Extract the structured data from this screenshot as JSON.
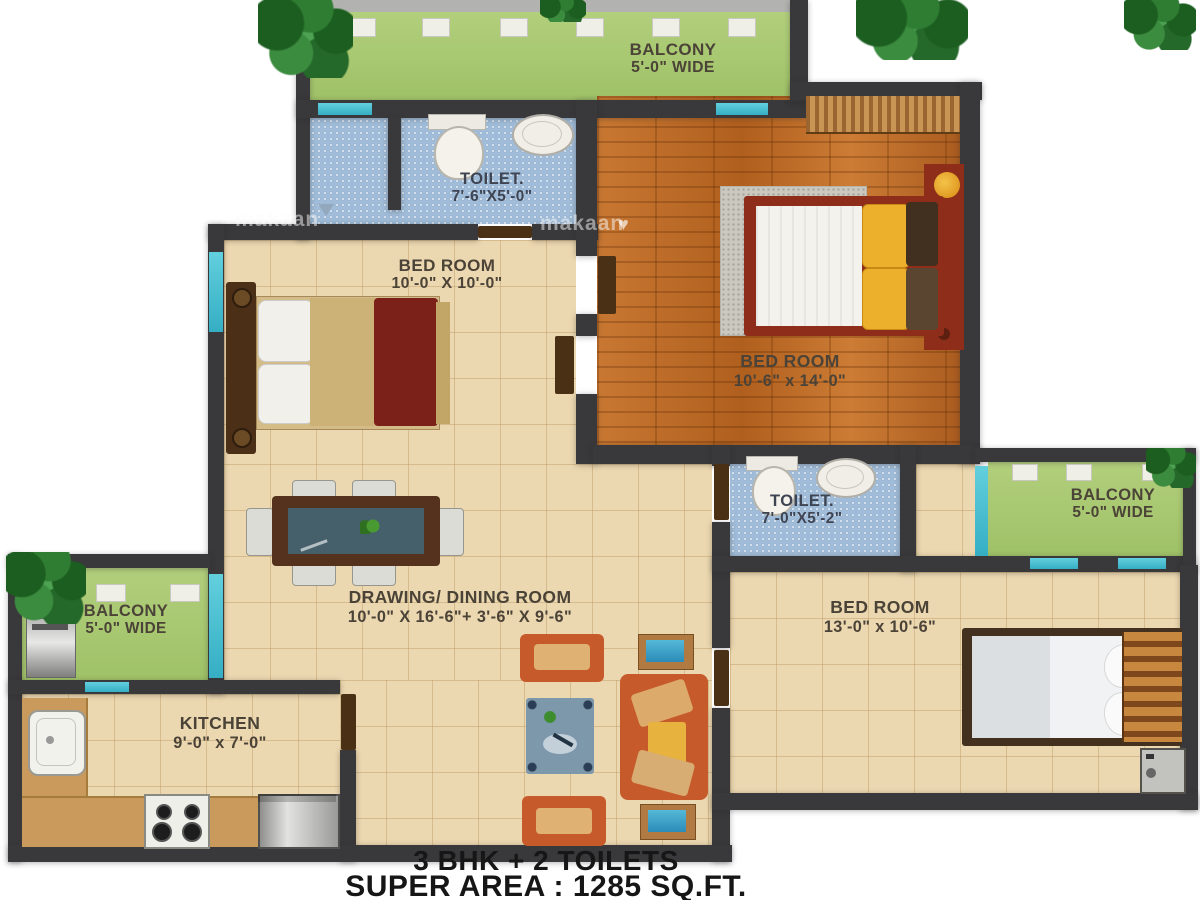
{
  "rooms": {
    "balcony_top": {
      "label": "BALCONY",
      "dims": "5'-0\" WIDE"
    },
    "toilet_top": {
      "label": "TOILET.",
      "dims": "7'-6\"X5'-0\""
    },
    "bedroom_left": {
      "label": "BED ROOM",
      "dims": "10'-0\" X 10'-0\""
    },
    "bedroom_master": {
      "label": "BED ROOM",
      "dims": "10'-6\" x 14'-0\""
    },
    "toilet_right": {
      "label": "TOILET.",
      "dims": "7'-0\"X5'-2\""
    },
    "balcony_right": {
      "label": "BALCONY",
      "dims": "5'-0\" WIDE"
    },
    "bedroom_bottom": {
      "label": "BED ROOM",
      "dims": "13'-0\" x 10'-6\""
    },
    "drawing_dining": {
      "label": "DRAWING/ DINING ROOM",
      "dims": "10'-0\" X 16'-6\"+ 3'-6\" X 9'-6\""
    },
    "balcony_left": {
      "label": "BALCONY",
      "dims": "5'-0\" WIDE"
    },
    "kitchen": {
      "label": "KITCHEN",
      "dims": "9'-0\" x 7'-0\""
    }
  },
  "footer": {
    "line1": "3 BHK + 2 TOILETS",
    "line2": "SUPER AREA : 1285 SQ.FT."
  },
  "watermark": {
    "text": "makaan",
    "heart": "♥"
  },
  "colors": {
    "wall": "#39383a",
    "floor_tile_beige": "#ecd8b0",
    "floor_wood": "#bf6f2c",
    "floor_bath_blue": "#a0bcd8",
    "balcony_green": "#a9c873",
    "window_teal": "#3fb6cc",
    "sofa_orange": "#c75a2a",
    "bed_frame_red": "#8e2e1a",
    "footer_text": "#161616"
  }
}
